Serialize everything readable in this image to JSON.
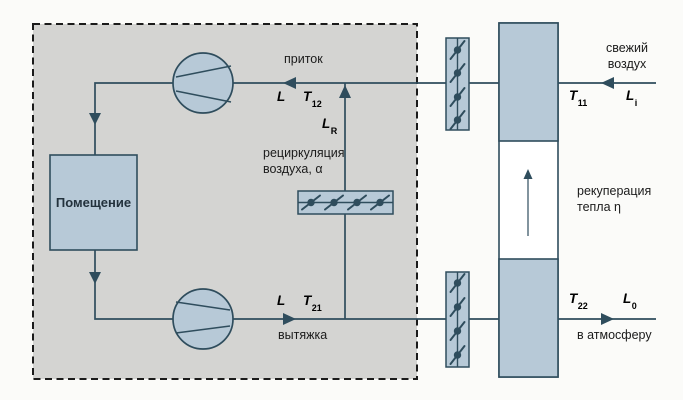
{
  "colors": {
    "blue": "#b7c9d7",
    "gray": "#d4d4d2",
    "line": "#2f4d5d",
    "ink": "#1b1b1b",
    "dash": "#1b1b1b"
  },
  "room": {
    "label": "Помещение"
  },
  "supply": {
    "flow_label": "приток",
    "l": "L",
    "t_base": "T",
    "t_sub": "12"
  },
  "exhaust": {
    "flow_label": "вытяжка",
    "l": "L",
    "t_base": "T",
    "t_sub": "21"
  },
  "recirculation": {
    "line1": "рециркуляция",
    "line2": "воздуха, α",
    "l_base": "L",
    "l_sub": "R"
  },
  "fresh_air": {
    "line1": "свежий",
    "line2": "воздух",
    "t_base": "T",
    "t_sub": "11",
    "l_base": "L",
    "l_sub": "i"
  },
  "to_atmosphere": {
    "label": "в атмосферу",
    "t_base": "T",
    "t_sub": "22",
    "l_base": "L",
    "l_sub": "0"
  },
  "recovery": {
    "line1": "рекуперация",
    "line2": "тепла η"
  }
}
